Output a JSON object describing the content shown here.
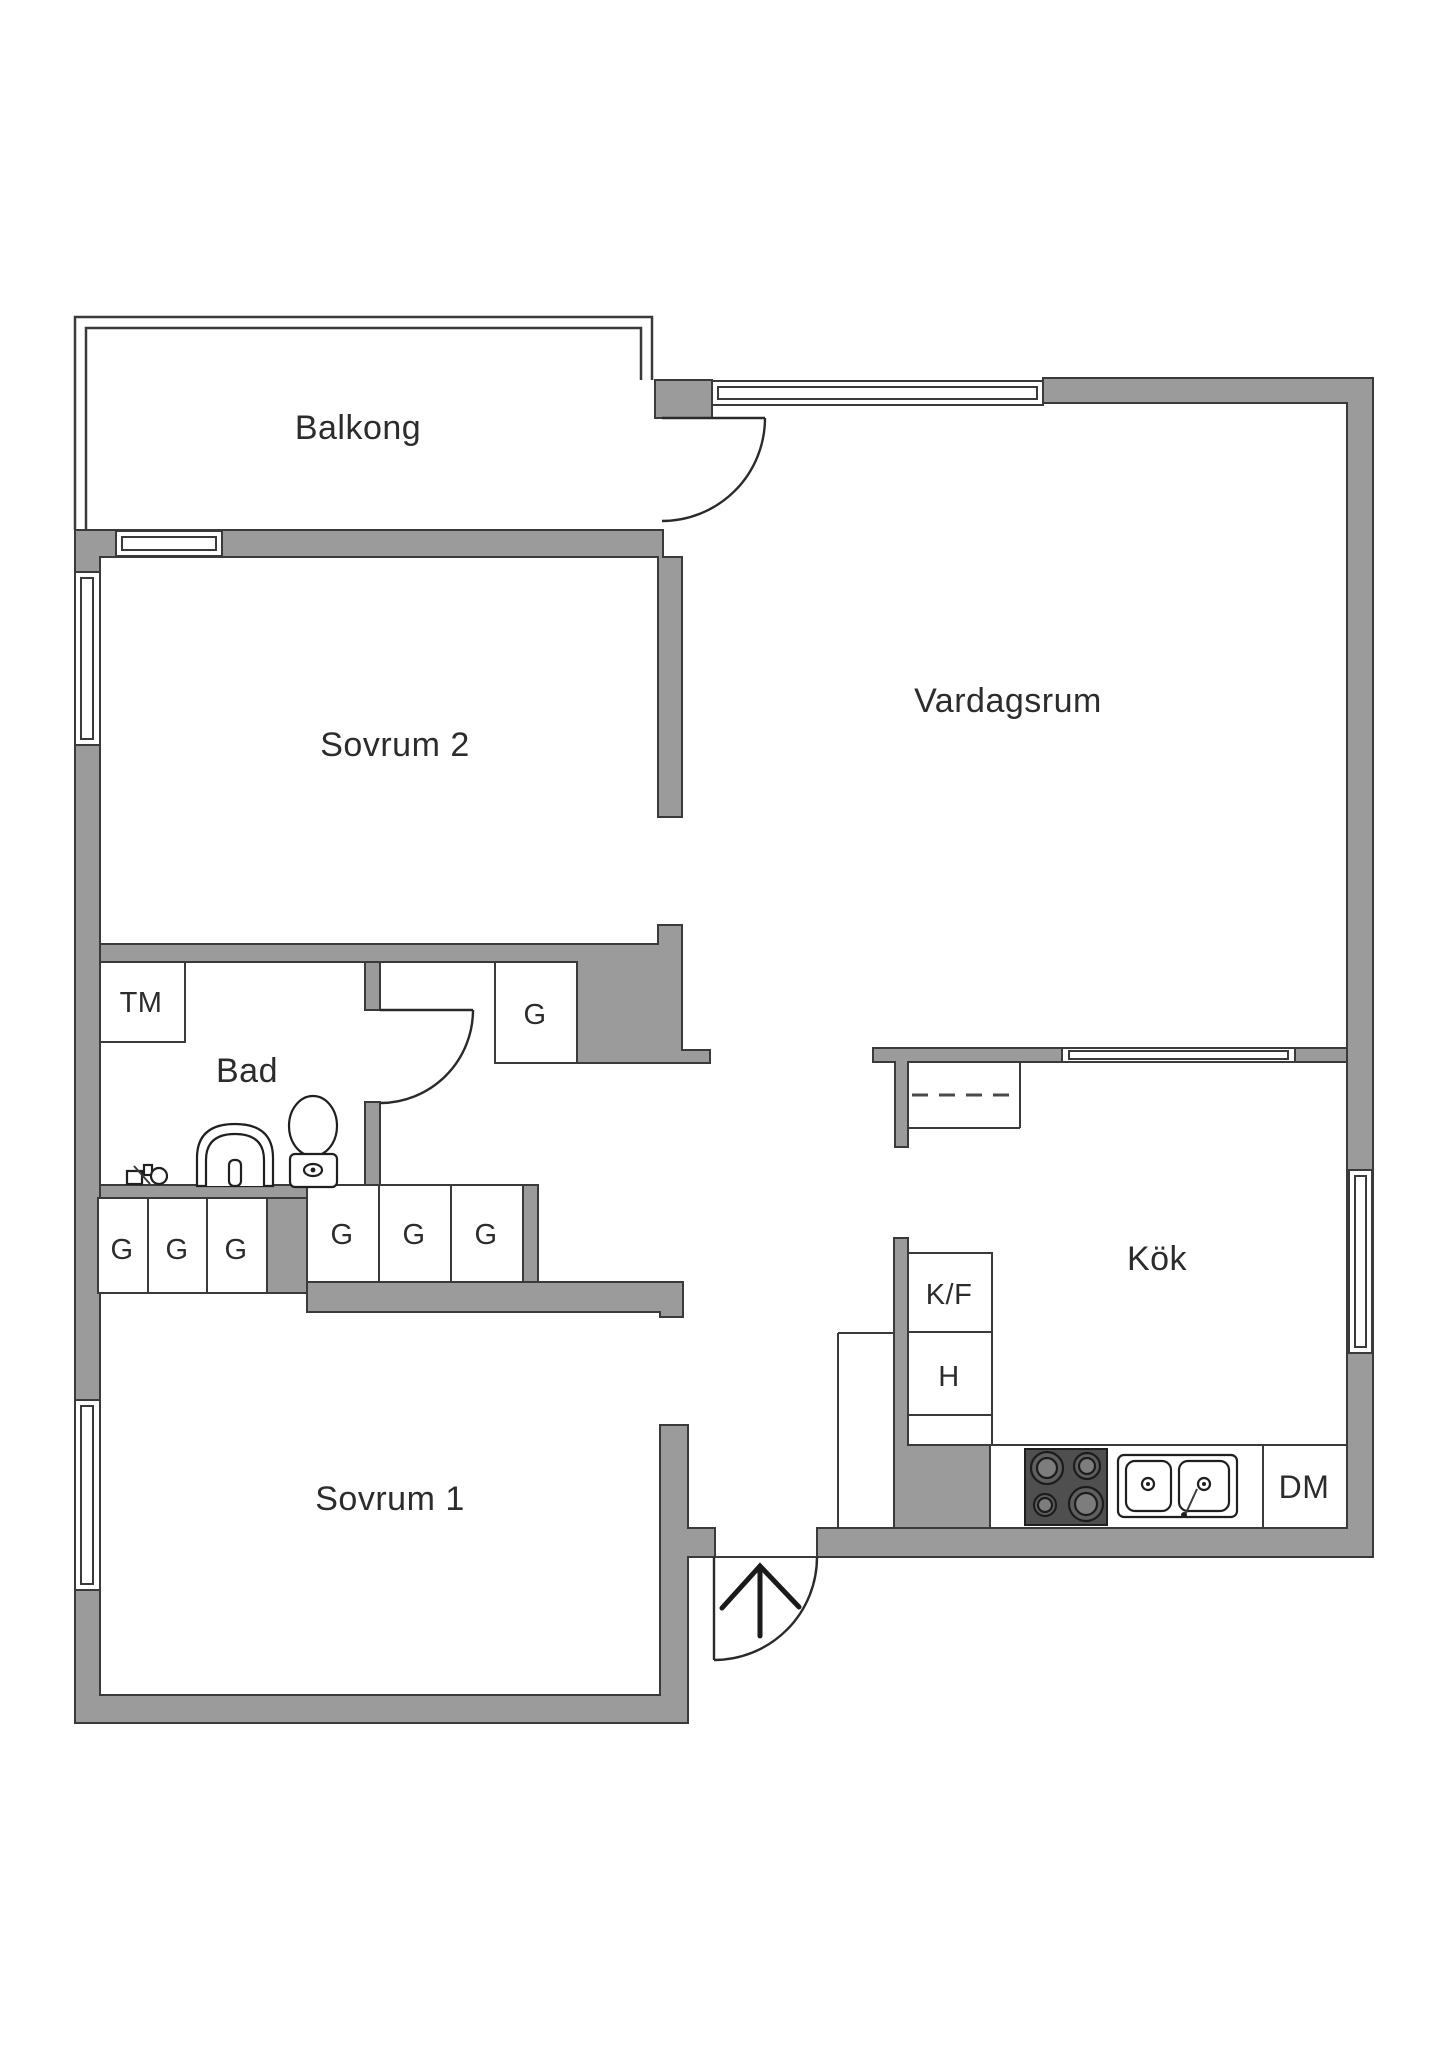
{
  "colors": {
    "wall": "#9b9b9b",
    "line": "#3a3a3a",
    "text": "#2c2c2c",
    "stove": "#4f4f4f"
  },
  "rooms": {
    "balcony": {
      "label": "Balkong"
    },
    "bedroom2": {
      "label": "Sovrum 2"
    },
    "living_room": {
      "label": "Vardagsrum"
    },
    "bathroom": {
      "label": "Bad"
    },
    "bedroom1": {
      "label": "Sovrum 1"
    },
    "kitchen": {
      "label": "Kök"
    }
  },
  "fixtures": {
    "washing_machine": {
      "label": "TM"
    },
    "fridge_freezer": {
      "label": "K/F"
    },
    "tall_cabinet": {
      "label": "H"
    },
    "dishwasher": {
      "label": "DM"
    },
    "wardrobes": {
      "bedroom1_row": [
        "G",
        "G",
        "G"
      ],
      "hall_row": [
        "G",
        "G",
        "G"
      ],
      "hall_single": "G"
    }
  }
}
